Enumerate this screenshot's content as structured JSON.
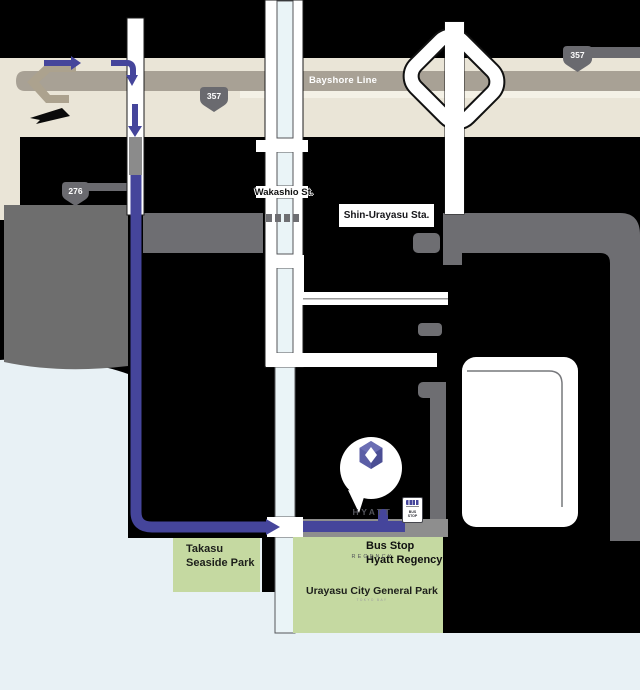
{
  "highway": {
    "name": "Bayshore Line",
    "shield_west": "357",
    "shield_east": "357"
  },
  "roads": {
    "route_276": "276",
    "street_label": "Wakashio St."
  },
  "railway": {
    "station_label": "Shin-Urayasu Sta."
  },
  "hotel_balloon": {
    "brand_line1": "HYATT",
    "brand_line2": "REGENCY",
    "brand_line3": "TOKYO BAY"
  },
  "bus_stop": {
    "sign_line1": "BUS",
    "sign_line2": "STOP",
    "label_line1": "Bus Stop",
    "label_line2": "Hyatt Regency"
  },
  "parks": {
    "takasu_line1": "Takasu",
    "takasu_line2": "Seaside Park",
    "urayasu": "Urayasu City General Park"
  },
  "colors": {
    "route_line": "#45459B",
    "park_green": "#C5D9A1",
    "water": "#E8F1F5",
    "highway_beige": "#EAE5D7",
    "road_gray": "#A8A195",
    "dark_gray": "#6E6E72",
    "street_fill": "#EAF4F7",
    "hyatt_purple": "#5B5EA6"
  }
}
